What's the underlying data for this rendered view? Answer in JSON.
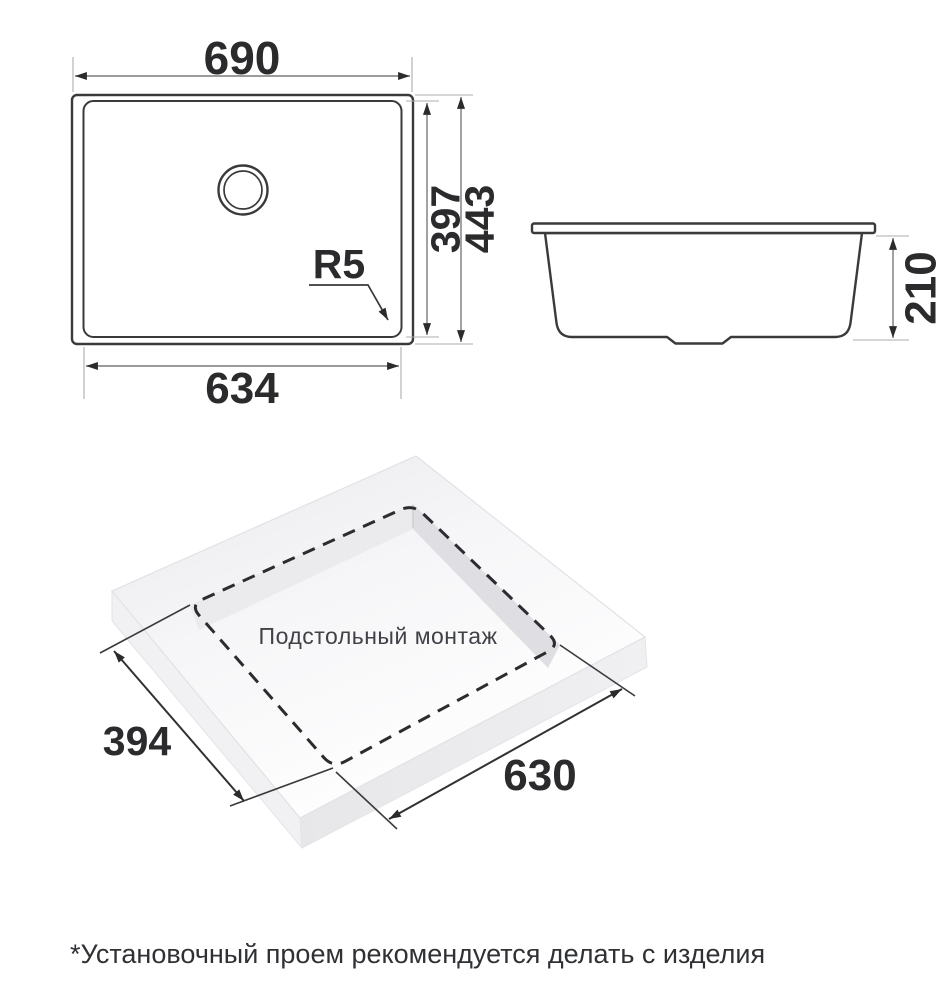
{
  "top_view": {
    "dim_width_top": "690",
    "dim_width_bottom": "634",
    "dim_height_inner": "397",
    "dim_height_outer": "443",
    "radius_label": "R5"
  },
  "side_view": {
    "dim_height": "210"
  },
  "iso_view": {
    "caption": "Подстольный монтаж",
    "dim_depth": "394",
    "dim_width": "630"
  },
  "footnote": {
    "text": "*Установочный проем рекомендуется делать с изделия"
  },
  "colors": {
    "background": "#ffffff",
    "object_line": "#3a3a3c",
    "dimension_line": "#7a7a7e",
    "extension_line": "#aeaeb2",
    "dash_line": "#2c2c2e",
    "slab_top_light": "#ffffff",
    "slab_top_shade": "#eaeaee",
    "slab_side": "#ececef",
    "cutout_wall": "#dfdfe3",
    "text_dark": "#2b2b2d"
  }
}
